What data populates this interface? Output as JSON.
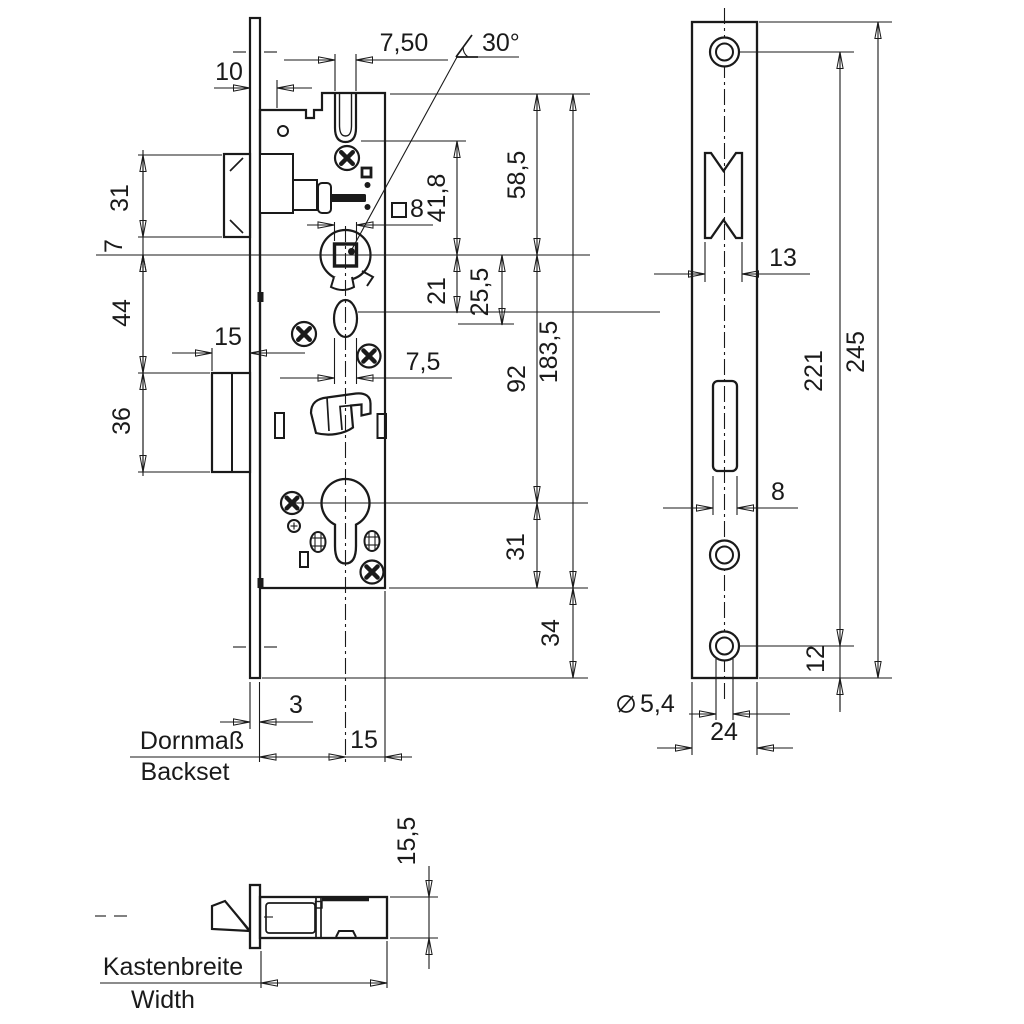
{
  "document": {
    "type": "technical-drawing",
    "subject": "mortise lock dimensional drawing",
    "background_color": "#ffffff",
    "line_color": "#1a1a1a"
  },
  "views": {
    "front": {
      "name": "lock case side view",
      "dims": {
        "offset_10": "10",
        "slot_width_top": "7,50",
        "angle": "30°",
        "latch_height": "31",
        "latch_to_axis": "7",
        "axis_to_deadbolt": "44",
        "deadbolt_throw": "15",
        "deadbolt_height": "36",
        "square_size": "8",
        "slot_to_axis": "41,8",
        "top_to_axis": "58,5",
        "axis_to_oval": "21",
        "axis_to_oval_bottom": "25,5",
        "oval_width": "7,5",
        "axis_to_cylinder": "92",
        "case_length": "183,5",
        "cylinder_to_bottom": "31",
        "plate_overhang": "34",
        "plate_thickness": "3",
        "cylinder_to_back": "15",
        "backset_de": "Dornmaß",
        "backset_en": "Backset"
      }
    },
    "faceplate": {
      "name": "faceplate front view",
      "dims": {
        "latch_cutout_width": "13",
        "screw_spacing": "221",
        "plate_length": "245",
        "cylinder_slot_width": "8",
        "bottom_screw_offset": "12",
        "screw_hole_diameter": "5,4",
        "plate_width": "24"
      }
    },
    "bottom": {
      "name": "lock case bottom view",
      "dims": {
        "case_height": "15,5",
        "width_de": "Kastenbreite",
        "width_en": "Width"
      }
    }
  }
}
